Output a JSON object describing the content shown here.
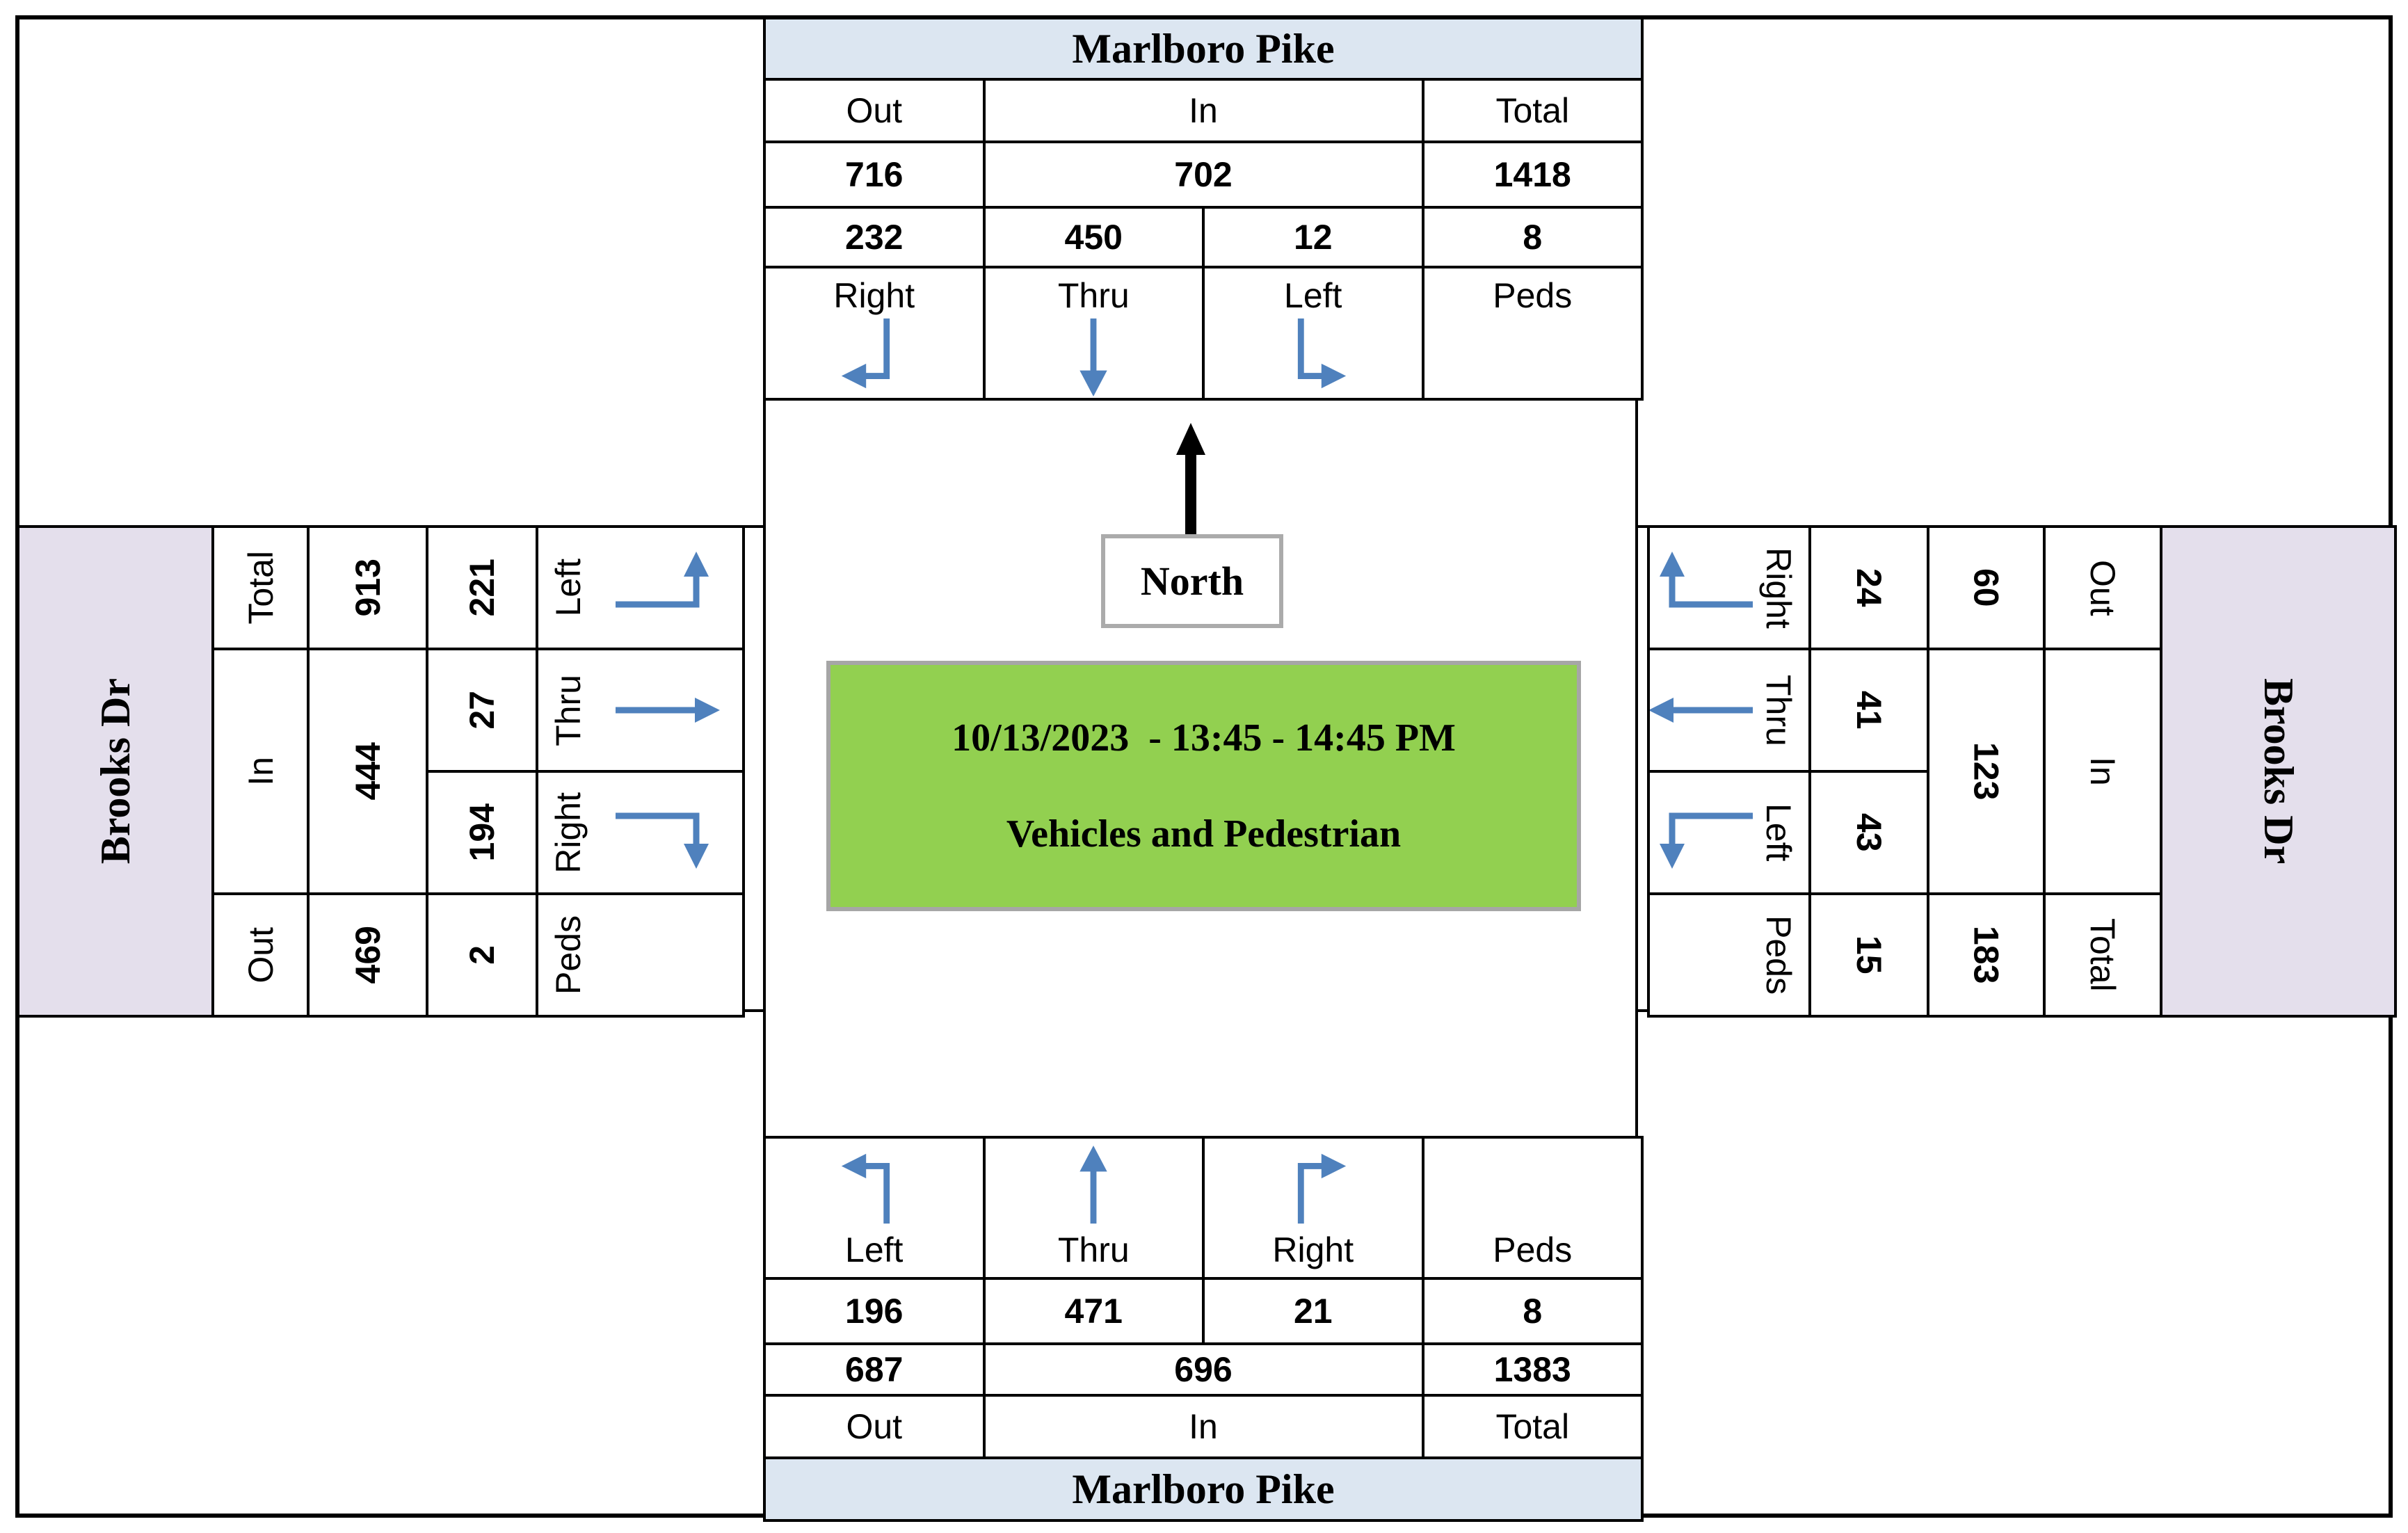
{
  "roads": {
    "north": "Marlboro Pike",
    "south": "Marlboro Pike",
    "west": "Brooks Dr",
    "east": "Brooks Dr"
  },
  "labels": {
    "out": "Out",
    "in": "In",
    "total": "Total",
    "left": "Left",
    "thru": "Thru",
    "right": "Right",
    "peds": "Peds",
    "north": "North"
  },
  "title": {
    "line1": "10/13/2023  - 13:45 - 14:45 PM",
    "line2": "Vehicles and Pedestrian"
  },
  "colors": {
    "road_header_blue": "#DCE6F1",
    "road_header_lavender": "#E4DFEC",
    "arrow_blue": "#4F81BD",
    "title_box_green": "#92D050",
    "box_border_gray": "#A6A6A6"
  },
  "counts": {
    "north": {
      "out": "716",
      "in": "702",
      "total": "1418",
      "movements": {
        "right": "232",
        "thru": "450",
        "left": "12",
        "peds": "8"
      },
      "arrows": {
        "right": "down-then-left",
        "thru": "down",
        "left": "down-then-right"
      }
    },
    "south": {
      "out": "687",
      "in": "696",
      "total": "1383",
      "movements": {
        "left": "196",
        "thru": "471",
        "right": "21",
        "peds": "8"
      },
      "arrows": {
        "left": "up-then-left",
        "thru": "up",
        "right": "up-then-right"
      }
    },
    "west": {
      "out": "469",
      "in": "444",
      "total": "913",
      "movements": {
        "left": "221",
        "thru": "27",
        "right": "194",
        "peds": "2"
      },
      "arrows": {
        "left": "right-then-up",
        "thru": "right",
        "right": "right-then-down"
      }
    },
    "east": {
      "out": "60",
      "in": "123",
      "total": "183",
      "movements": {
        "right": "24",
        "thru": "41",
        "left": "43",
        "peds": "15"
      },
      "arrows": {
        "right": "left-then-up",
        "thru": "left",
        "left": "left-then-down"
      }
    }
  }
}
